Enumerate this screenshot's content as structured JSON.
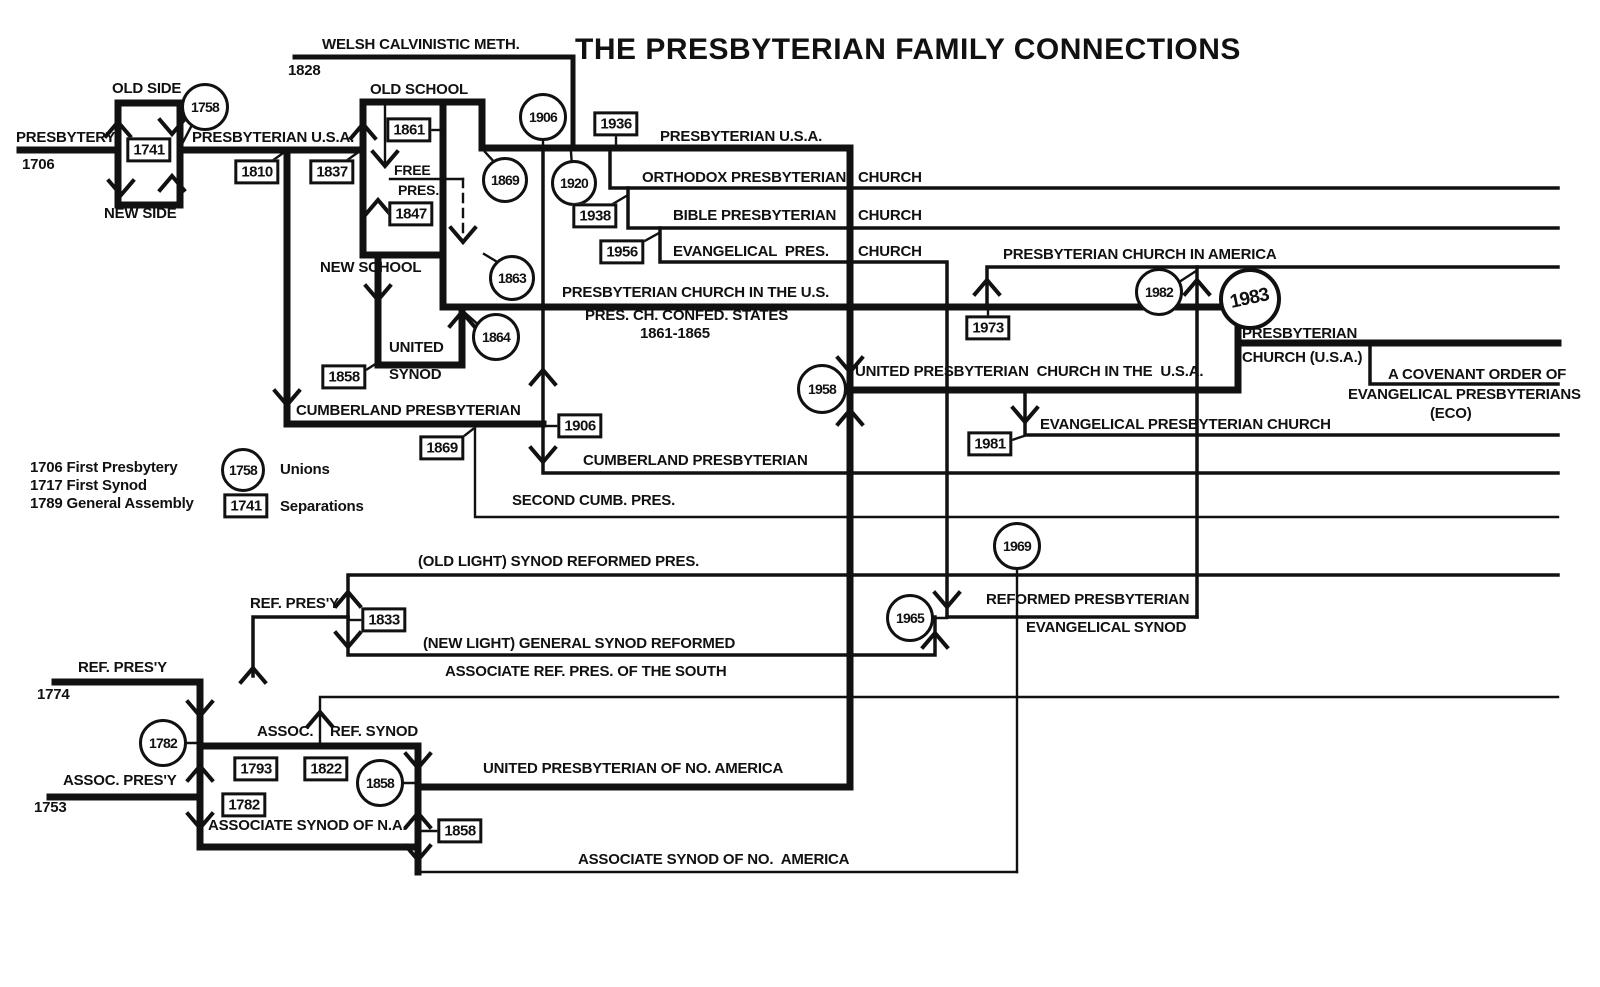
{
  "colors": {
    "ink": "#111111",
    "background": "#ffffff"
  },
  "legend": {
    "history": [
      "1706 First Presbytery",
      "1717 First Synod",
      "1789 General Assembly"
    ],
    "unions_year": "1758",
    "unions_label": "Unions",
    "separations_year": "1741",
    "separations_label": "Separations"
  },
  "labels": [
    {
      "name": "diagram-title",
      "text": "THE PRESBYTERIAN FAMILY CONNECTIONS",
      "x": 575,
      "y": 34,
      "size": 30,
      "title": true
    },
    {
      "name": "label-welsh-calvinistic-meth",
      "text": "WELSH CALVINISTIC METH.",
      "x": 322,
      "y": 37
    },
    {
      "name": "label-1828",
      "text": "1828",
      "x": 288,
      "y": 63
    },
    {
      "name": "label-old-side",
      "text": "OLD SIDE",
      "x": 112,
      "y": 81
    },
    {
      "name": "label-presbytery",
      "text": "PRESBYTERY",
      "x": 16,
      "y": 130
    },
    {
      "name": "label-1706",
      "text": "1706",
      "x": 22,
      "y": 157
    },
    {
      "name": "label-new-side",
      "text": "NEW SIDE",
      "x": 104,
      "y": 206
    },
    {
      "name": "label-presbyterian-usa-left",
      "text": "PRESBYTERIAN U.S.A.",
      "x": 192,
      "y": 130
    },
    {
      "name": "label-old-school",
      "text": "OLD SCHOOL",
      "x": 370,
      "y": 82
    },
    {
      "name": "label-free",
      "text": "FREE",
      "x": 394,
      "y": 163,
      "size": 14
    },
    {
      "name": "label-pres",
      "text": "PRES.",
      "x": 398,
      "y": 183,
      "size": 14
    },
    {
      "name": "label-new-school",
      "text": "NEW SCHOOL",
      "x": 320,
      "y": 260
    },
    {
      "name": "label-presbyterian-usa-top",
      "text": "PRESBYTERIAN U.S.A.",
      "x": 660,
      "y": 129
    },
    {
      "name": "label-orthodox-presbyterian",
      "text": "ORTHODOX PRESBYTERIAN",
      "x": 642,
      "y": 170
    },
    {
      "name": "label-orthodox-church",
      "text": "CHURCH",
      "x": 858,
      "y": 170
    },
    {
      "name": "label-bible-presbyterian",
      "text": "BIBLE PRESBYTERIAN",
      "x": 673,
      "y": 208
    },
    {
      "name": "label-bible-church",
      "text": "CHURCH",
      "x": 858,
      "y": 208
    },
    {
      "name": "label-evangelical-pres",
      "text": "EVANGELICAL  PRES.",
      "x": 673,
      "y": 244
    },
    {
      "name": "label-evangelical-church",
      "text": "CHURCH",
      "x": 858,
      "y": 244
    },
    {
      "name": "label-presbyterian-church-in-america",
      "text": "PRESBYTERIAN CHURCH IN AMERICA",
      "x": 1003,
      "y": 247
    },
    {
      "name": "label-presbyterian-church-in-the-us",
      "text": "PRESBYTERIAN CHURCH IN THE U.S.",
      "x": 562,
      "y": 285
    },
    {
      "name": "label-pres-ch-confed-states",
      "text": "PRES. CH. CONFED. STATES",
      "x": 585,
      "y": 308
    },
    {
      "name": "label-1861-1865",
      "text": "1861-1865",
      "x": 640,
      "y": 326
    },
    {
      "name": "label-united",
      "text": "UNITED",
      "x": 389,
      "y": 340
    },
    {
      "name": "label-synod",
      "text": "SYNOD",
      "x": 389,
      "y": 367
    },
    {
      "name": "label-cumberland-presbyterian-upper",
      "text": "CUMBERLAND PRESBYTERIAN",
      "x": 296,
      "y": 403
    },
    {
      "name": "label-united-presbyterian-church-usa",
      "text": "UNITED PRESBYTERIAN  CHURCH IN THE  U.S.A.",
      "x": 855,
      "y": 364
    },
    {
      "name": "label-presbyterian-1983",
      "text": "PRESBYTERIAN",
      "x": 1242,
      "y": 326
    },
    {
      "name": "label-church-usa-1983",
      "text": "CHURCH (U.S.A.)",
      "x": 1242,
      "y": 350
    },
    {
      "name": "label-covenant-order",
      "text": "A COVENANT ORDER OF",
      "x": 1388,
      "y": 367
    },
    {
      "name": "label-evangelical-presbyterians",
      "text": "EVANGELICAL PRESBYTERIANS",
      "x": 1348,
      "y": 387
    },
    {
      "name": "label-eco",
      "text": "(ECO)",
      "x": 1430,
      "y": 406
    },
    {
      "name": "label-evangelical-presbyterian-church",
      "text": "EVANGELICAL PRESBYTERIAN CHURCH",
      "x": 1040,
      "y": 417
    },
    {
      "name": "label-cumberland-presbyterian-lower",
      "text": "CUMBERLAND PRESBYTERIAN",
      "x": 583,
      "y": 453
    },
    {
      "name": "label-second-cumb-pres",
      "text": "SECOND CUMB. PRES.",
      "x": 512,
      "y": 493
    },
    {
      "name": "legend-first-presbytery",
      "text": "1706 First Presbytery",
      "x": 30,
      "y": 460
    },
    {
      "name": "legend-first-synod",
      "text": "1717 First Synod",
      "x": 30,
      "y": 478
    },
    {
      "name": "legend-general-assembly",
      "text": "1789 General Assembly",
      "x": 30,
      "y": 496
    },
    {
      "name": "legend-unions",
      "text": "Unions",
      "x": 280,
      "y": 462
    },
    {
      "name": "legend-separations",
      "text": "Separations",
      "x": 280,
      "y": 499
    },
    {
      "name": "label-old-light-synod-reformed-pres",
      "text": "(OLD LIGHT) SYNOD REFORMED PRES.",
      "x": 418,
      "y": 554
    },
    {
      "name": "label-ref-presy-upper",
      "text": "REF. PRES'Y",
      "x": 250,
      "y": 596
    },
    {
      "name": "label-new-light-general-synod-reformed",
      "text": "(NEW LIGHT) GENERAL SYNOD REFORMED",
      "x": 423,
      "y": 636
    },
    {
      "name": "label-reformed-presbyterian",
      "text": "REFORMED PRESBYTERIAN",
      "x": 986,
      "y": 592
    },
    {
      "name": "label-evangelical-synod",
      "text": "EVANGELICAL SYNOD",
      "x": 1026,
      "y": 620
    },
    {
      "name": "label-ref-presy-1774",
      "text": "REF. PRES'Y",
      "x": 78,
      "y": 660
    },
    {
      "name": "label-1774",
      "text": "1774",
      "x": 37,
      "y": 687
    },
    {
      "name": "label-assoc-presy",
      "text": "ASSOC. PRES'Y",
      "x": 63,
      "y": 773
    },
    {
      "name": "label-1753",
      "text": "1753",
      "x": 34,
      "y": 800
    },
    {
      "name": "label-assoc",
      "text": "ASSOC.",
      "x": 257,
      "y": 724
    },
    {
      "name": "label-ref-synod",
      "text": "REF. SYNOD",
      "x": 330,
      "y": 724
    },
    {
      "name": "label-associate-ref-pres-south",
      "text": "ASSOCIATE REF. PRES. OF THE SOUTH",
      "x": 445,
      "y": 664
    },
    {
      "name": "label-united-presbyterian-no-america",
      "text": "UNITED PRESBYTERIAN OF NO. AMERICA",
      "x": 483,
      "y": 761
    },
    {
      "name": "label-associate-synod-na",
      "text": "ASSOCIATE SYNOD OF N.A.",
      "x": 208,
      "y": 818
    },
    {
      "name": "label-associate-synod-no-america",
      "text": "ASSOCIATE SYNOD OF NO.  AMERICA",
      "x": 578,
      "y": 852
    }
  ],
  "markers": {
    "circles": [
      {
        "name": "year-circle-1758-old-new-side-union",
        "year": "1758",
        "x": 205,
        "y": 107,
        "r": 21
      },
      {
        "name": "year-circle-1906-cumberland-union",
        "year": "1906",
        "x": 543,
        "y": 117,
        "r": 21
      },
      {
        "name": "year-circle-1869-old-new-school-union",
        "year": "1869",
        "x": 505,
        "y": 180,
        "r": 20
      },
      {
        "name": "year-circle-1920-welsh-union",
        "year": "1920",
        "x": 574,
        "y": 183,
        "r": 20
      },
      {
        "name": "year-circle-1863",
        "year": "1863",
        "x": 512,
        "y": 278,
        "r": 20
      },
      {
        "name": "year-circle-1864-united-synod-union",
        "year": "1864",
        "x": 496,
        "y": 337,
        "r": 21
      },
      {
        "name": "year-circle-1958-upcusa-union",
        "year": "1958",
        "x": 822,
        "y": 389,
        "r": 22
      },
      {
        "name": "year-circle-1982-pca-union",
        "year": "1982",
        "x": 1159,
        "y": 292,
        "r": 21
      },
      {
        "name": "year-circle-1983-pcusa-union",
        "year": "1983",
        "x": 1250,
        "y": 299,
        "r": 27,
        "big": true
      },
      {
        "name": "year-circle-1969",
        "year": "1969",
        "x": 1017,
        "y": 546,
        "r": 21
      },
      {
        "name": "year-circle-1965-rpes-union",
        "year": "1965",
        "x": 910,
        "y": 618,
        "r": 21
      },
      {
        "name": "year-circle-1782-assoc-reformed-union",
        "year": "1782",
        "x": 163,
        "y": 743,
        "r": 21
      },
      {
        "name": "year-circle-1858-upna-union",
        "year": "1858",
        "x": 380,
        "y": 783,
        "r": 21
      },
      {
        "name": "legend-unions-symbol",
        "year": "1758",
        "x": 243,
        "y": 470,
        "r": 19
      }
    ],
    "boxes": [
      {
        "name": "year-box-1741-old-new-side-split",
        "year": "1741",
        "x": 149,
        "y": 150
      },
      {
        "name": "year-box-1810-cumberland-split",
        "year": "1810",
        "x": 257,
        "y": 172
      },
      {
        "name": "year-box-1837-old-new-school-split",
        "year": "1837",
        "x": 332,
        "y": 172
      },
      {
        "name": "year-box-1861",
        "year": "1861",
        "x": 409,
        "y": 130
      },
      {
        "name": "year-box-1847-free-pres-split",
        "year": "1847",
        "x": 411,
        "y": 214
      },
      {
        "name": "year-box-1936-orthodox-split",
        "year": "1936",
        "x": 616,
        "y": 124
      },
      {
        "name": "year-box-1938-bible-split",
        "year": "1938",
        "x": 595,
        "y": 216
      },
      {
        "name": "year-box-1956-evangelical-split",
        "year": "1956",
        "x": 622,
        "y": 252
      },
      {
        "name": "year-box-1973-pca-split",
        "year": "1973",
        "x": 988,
        "y": 328
      },
      {
        "name": "year-box-1981-epc-split",
        "year": "1981",
        "x": 990,
        "y": 444
      },
      {
        "name": "year-box-1858-united-synod-split",
        "year": "1858",
        "x": 344,
        "y": 377
      },
      {
        "name": "year-box-1906-cumberland-remnant",
        "year": "1906",
        "x": 580,
        "y": 426
      },
      {
        "name": "year-box-1869-second-cumb-split",
        "year": "1869",
        "x": 442,
        "y": 448
      },
      {
        "name": "year-box-1833-old-new-light-split",
        "year": "1833",
        "x": 384,
        "y": 620
      },
      {
        "name": "year-box-1793",
        "year": "1793",
        "x": 256,
        "y": 769
      },
      {
        "name": "year-box-1822-arp-south-split",
        "year": "1822",
        "x": 326,
        "y": 769
      },
      {
        "name": "year-box-1782",
        "year": "1782",
        "x": 244,
        "y": 805
      },
      {
        "name": "year-box-1858-associate-synod-remnant",
        "year": "1858",
        "x": 460,
        "y": 831
      },
      {
        "name": "legend-separations-symbol",
        "year": "1741",
        "x": 246,
        "y": 506
      }
    ]
  }
}
